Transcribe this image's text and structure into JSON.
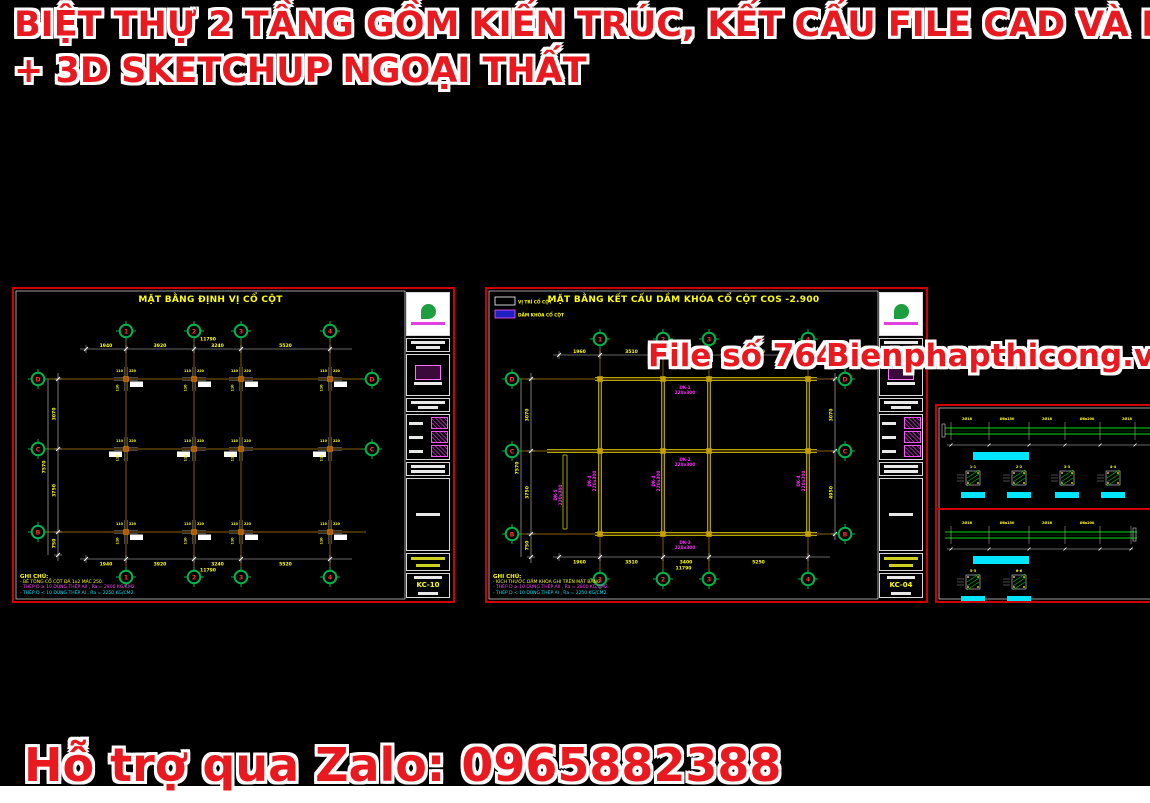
{
  "header": {
    "line1": "BIỆT THỰ 2 TẦNG GỒM KIẾN TRÚC, KẾT CẤU FILE CAD VÀ PDF",
    "line2": "+ 3D SKETCHUP NGOẠI THẤT"
  },
  "watermark": {
    "file_no": "File số 764",
    "site": "Bienphapthicong.vn"
  },
  "footer": {
    "support": "Hỗ trợ qua Zalo: 0965882388"
  },
  "colors": {
    "accent_red": "#e8191f",
    "sheet_border": "#cf0000",
    "cad_yellow": "#ffff00",
    "cad_orange": "#bd7e00",
    "cad_green": "#00b44c",
    "cad_magenta": "#ff29ff",
    "cad_cyan": "#00e5ff",
    "beam_yellow": "#e8e000",
    "detail_green": "#00dd00"
  },
  "sheet1": {
    "title": "MẶT BẰNG ĐỊNH VỊ CỔ CỘT",
    "sheet_no": "KC-10",
    "notes": {
      "title": "GHI CHÚ:",
      "lines": [
        "- BÊ TÔNG CỔ CỘT ĐÁ 1x2 MÁC 250.",
        "- THÉP D ≥ 10 DÙNG THÉP AII , Ra = 2800 KG/CM2.",
        "- THÉP D < 10 DÙNG THÉP AI , Ra = 2250 KG/CM2."
      ]
    },
    "geom": {
      "cols": [
        {
          "x": 112,
          "t": "1"
        },
        {
          "x": 180,
          "t": "2"
        },
        {
          "x": 227,
          "t": "3"
        },
        {
          "x": 316,
          "t": "4"
        }
      ],
      "rows": [
        {
          "y": 90,
          "t": "D"
        },
        {
          "y": 160,
          "t": "C"
        },
        {
          "y": 243,
          "t": "B"
        }
      ],
      "rows_right": [
        {
          "y": 90,
          "t": "D"
        },
        {
          "y": 160,
          "t": "C"
        }
      ],
      "top_bubble_y": 42,
      "bot_bubble_y": 288,
      "left_bubble_x": 24,
      "right_bubble_x": 358,
      "dim_top": {
        "y": 60,
        "xs": [
          72,
          112,
          180,
          227,
          316
        ],
        "labels": [
          "1940",
          "3920",
          "3240",
          "5520"
        ],
        "total": "11790"
      },
      "dim_bot": {
        "y": 270,
        "xs": [
          72,
          112,
          180,
          227,
          316
        ],
        "labels": [
          "1940",
          "3920",
          "3240",
          "5520"
        ],
        "total": "11790"
      },
      "dim_left": {
        "x": 44,
        "total_x": 34,
        "ys": [
          90,
          160,
          243,
          266
        ],
        "labels": [
          "3070",
          "3750",
          "750"
        ],
        "total": "7570"
      },
      "col_marks": [
        "110",
        "220"
      ]
    }
  },
  "sheet2": {
    "title": "MẶT BẰNG KẾT CẤU DẦM KHÓA CỔ CỘT COS -2.900",
    "sheet_no": "KC-04",
    "legend": [
      {
        "label": "VỊ TRÍ CỔ CỘT"
      },
      {
        "label": "DẦM KHÓA CỔ CỘT"
      }
    ],
    "notes": {
      "title": "GHI CHÚ:",
      "lines": [
        "- KÍCH THƯỚC DẦM KHÓA GHI TRÊN MẶT BẰNG.",
        "- THÉP D ≥ 10 DÙNG THÉP AII , Ra = 2800 KG/CM2.",
        "- THÉP D < 10 DÙNG THÉP AI , Ra = 2250 KG/CM2."
      ]
    },
    "geom": {
      "cols": [
        {
          "x": 113,
          "t": "1"
        },
        {
          "x": 176,
          "t": "2"
        },
        {
          "x": 222,
          "t": "3"
        },
        {
          "x": 321,
          "t": "4"
        }
      ],
      "rows": [
        {
          "y": 90,
          "t": "D"
        },
        {
          "y": 162,
          "t": "C"
        },
        {
          "y": 245,
          "t": "B"
        }
      ],
      "rows_right": [
        {
          "y": 90,
          "t": "D"
        },
        {
          "y": 162,
          "t": "C"
        },
        {
          "y": 245,
          "t": "B"
        }
      ],
      "top_bubble_y": 50,
      "bot_bubble_y": 290,
      "left_bubble_x": 25,
      "right_bubble_x": 358,
      "dim_top": {
        "y": 66,
        "xs": [
          72,
          113,
          176,
          222,
          321
        ],
        "labels": [
          "1960",
          "3510",
          "3400",
          "5250"
        ],
        "total": "11790"
      },
      "dim_bot": {
        "y": 268,
        "xs": [
          72,
          113,
          176,
          222,
          321
        ],
        "labels": [
          "1960",
          "3510",
          "3400",
          "5250"
        ],
        "total": "11790"
      },
      "dim_left": {
        "x": 44,
        "total_x": 34,
        "ys": [
          90,
          162,
          245,
          268
        ],
        "labels": [
          "3070",
          "3750",
          "750"
        ],
        "total": "7570"
      },
      "dim_right": {
        "x": 348,
        "ys": [
          90,
          162,
          245
        ],
        "labels": [
          "3070",
          "4950"
        ]
      },
      "beams": {
        "h": [
          {
            "y": 90,
            "x1": 108,
            "x2": 330
          },
          {
            "y": 162,
            "x1": 60,
            "x2": 330
          },
          {
            "y": 245,
            "x1": 108,
            "x2": 330
          }
        ],
        "v": [
          {
            "x": 113,
            "y1": 88,
            "y2": 247
          },
          {
            "x": 176,
            "y1": 88,
            "y2": 247
          },
          {
            "x": 222,
            "y1": 88,
            "y2": 247
          },
          {
            "x": 321,
            "y1": 88,
            "y2": 247
          }
        ],
        "strip": {
          "x": 78,
          "y1": 166,
          "y2": 240
        }
      },
      "beam_labels": [
        {
          "x": 198,
          "y": 100,
          "rot": 0,
          "name": "DK-1",
          "size": "220x300"
        },
        {
          "x": 198,
          "y": 172,
          "rot": 0,
          "name": "DK-2",
          "size": "220x300"
        },
        {
          "x": 198,
          "y": 255,
          "rot": 0,
          "name": "DK-3",
          "size": "220x300"
        },
        {
          "x": 104,
          "y": 192,
          "rot": -90,
          "name": "DK-4",
          "size": "220x300"
        },
        {
          "x": 168,
          "y": 192,
          "rot": -90,
          "name": "DK-4",
          "size": "220x300"
        },
        {
          "x": 313,
          "y": 192,
          "rot": -90,
          "name": "DK-4",
          "size": "220x300"
        },
        {
          "x": 70,
          "y": 206,
          "rot": -90,
          "name": "DK-5",
          "size": "220x300"
        }
      ]
    }
  },
  "sheet3": {
    "labels_top": [
      "2Ø18",
      "Ø6a150",
      "2Ø18",
      "Ø6a200",
      "2Ø18"
    ],
    "labels_bottom": [
      "2Ø16",
      "Ø6a150",
      "2Ø16",
      "Ø6a200"
    ],
    "section_labels_top": [
      "1-1",
      "2-2",
      "3-3",
      "4-4"
    ],
    "section_labels_bottom": [
      "5-5",
      "6-6"
    ]
  }
}
